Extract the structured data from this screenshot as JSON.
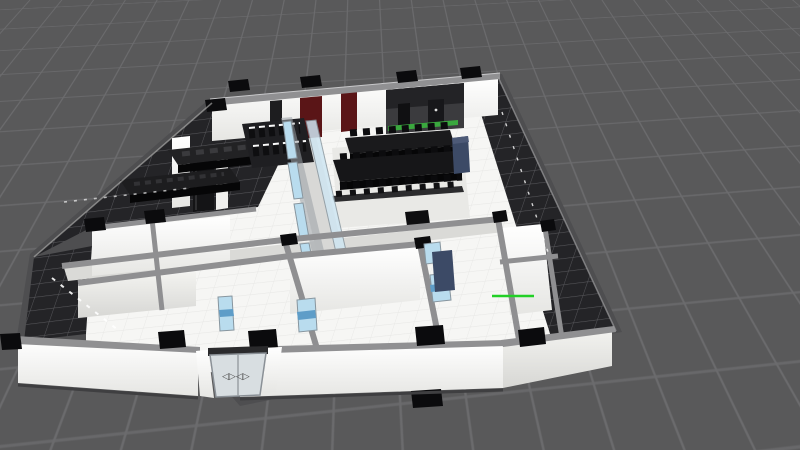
{
  "meta": {
    "description": "3D cutaway floor-plan render of an office interior, viewed from above at an angle inside a dark 3D viewport with a perspective ground grid. No UI chrome, text or panels are visible; the only glyphs are the arrow decals on the sliding entrance door and a green axis gizmo line.",
    "view": "perspective 3D viewport"
  },
  "palette": {
    "viewport_bg": "#59595a",
    "grid_line": "#6b6b6d",
    "dark_floor": "#242427",
    "dark_floor_grout": "#56565a",
    "white_floor": "#f6f6f4",
    "white_floor_grout": "#e8e8e6",
    "wall_top": "#909092",
    "wall_face_light": "#ffffff",
    "wall_face_shade": "#dcdcd9",
    "column_cap": "#0b0b0d",
    "accent_wall_red": "#5a1517",
    "back_wall_dark": "#3b3b3e",
    "glass_blue": "#b9dcee",
    "glass_band_blue": "#5e9dc8",
    "furniture_black": "#141416",
    "cabinet_navy": "#3c4a66",
    "led_strip_green": "#3aa83e",
    "gizmo_green": "#22d026",
    "light_dash_white": "#ffffff",
    "door_decal_gray": "#4b4b4b"
  },
  "scene": {
    "ground": {
      "type": "perspective-grid-plane"
    },
    "building": {
      "floors": [
        "dark tiled apron (north-west, west and east bands)",
        "white tiled room floors",
        "gray corridor strips"
      ],
      "rooms": [
        "kitchen / bar",
        "display-shelf room",
        "conference room with table rows",
        "meeting rooms",
        "offices",
        "glass corridor",
        "entrance lobby"
      ],
      "objects": [
        "black kitchen counters",
        "tall black cabinet",
        "shelf displays with black boxes",
        "two conference tables with chair rows",
        "navy cabinets and desk",
        "blue glass partition wall segments",
        "interior blue windows",
        "dark red accent wall panels",
        "green LED strip on kitchen back wall",
        "black column caps on walls",
        "white ceiling-light dashes on dark floor",
        "sliding glass entrance door"
      ]
    },
    "entrance": {
      "decal_glyphs": "◁▷◁▷"
    },
    "markers": {
      "axis_gizmo": "short horizontal bright-green line near right wing"
    }
  }
}
